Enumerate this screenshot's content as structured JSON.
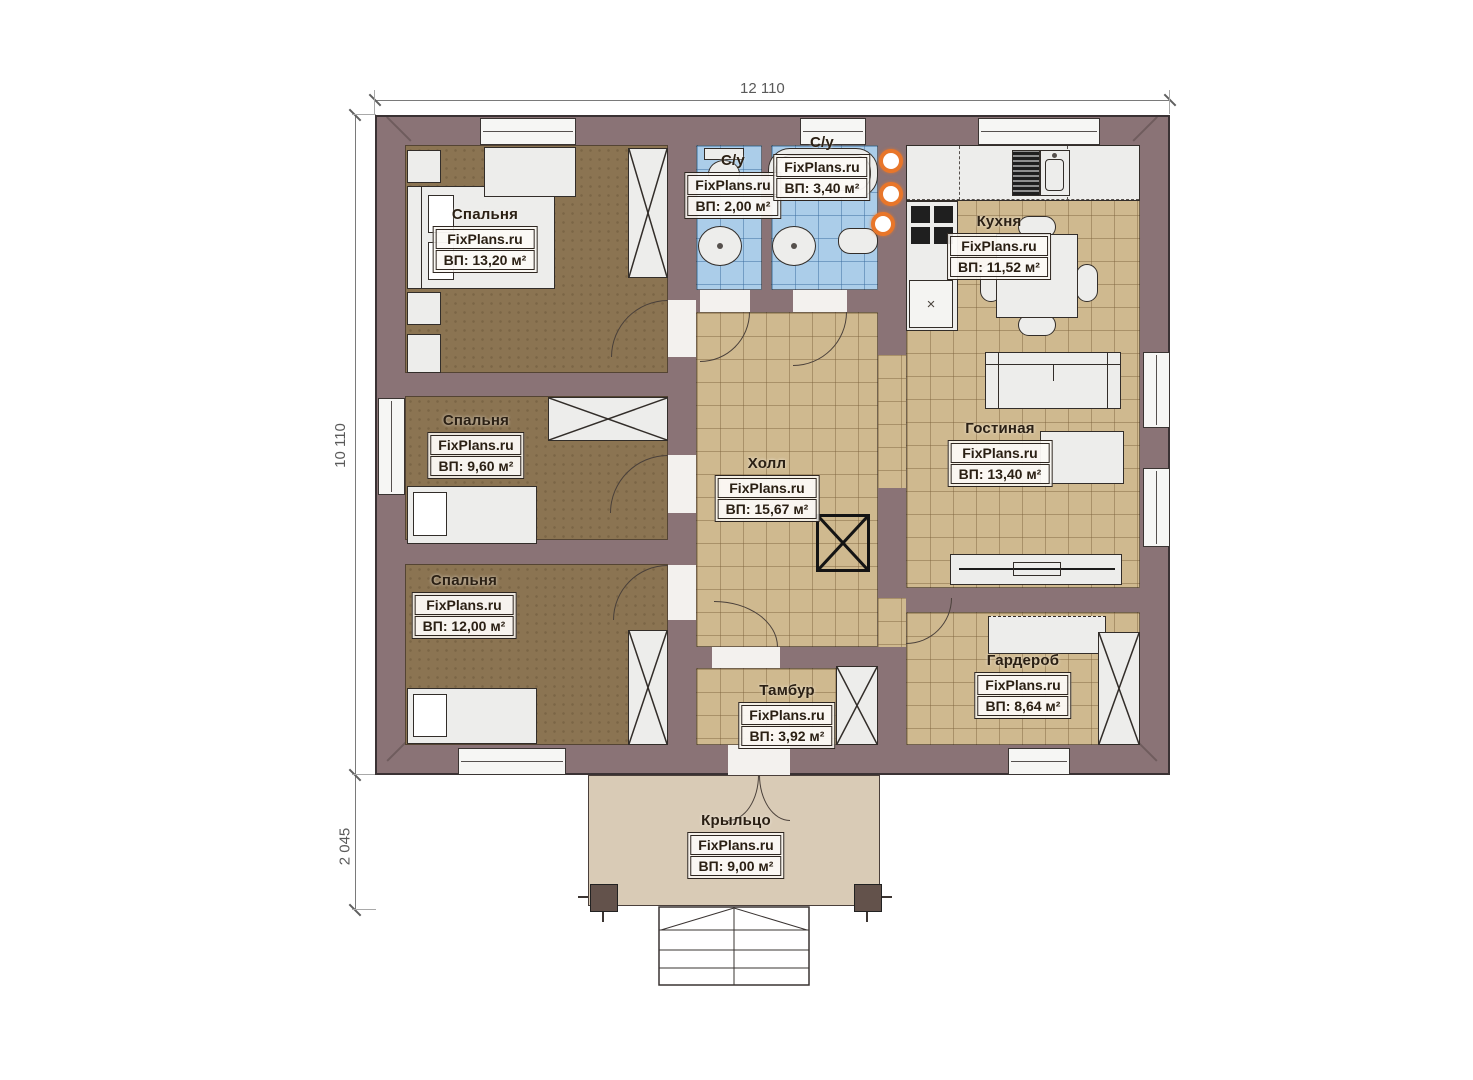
{
  "watermark": "FixPlans.ru",
  "dimensions": {
    "width_total": "12 110",
    "height_main": "10 110",
    "height_porch": "2 045"
  },
  "rooms": {
    "bedroom1": {
      "name": "Спальня",
      "area": "ВП: 13,20 м²"
    },
    "bedroom2": {
      "name": "Спальня",
      "area": "ВП: 9,60 м²"
    },
    "bedroom3": {
      "name": "Спальня",
      "area": "ВП: 12,00 м²"
    },
    "bathroom1": {
      "name": "С/у",
      "area": "ВП: 2,00 м²"
    },
    "bathroom2": {
      "name": "С/у",
      "area": "ВП: 3,40 м²"
    },
    "kitchen": {
      "name": "Кухня",
      "area": "ВП: 11,52 м²"
    },
    "living": {
      "name": "Гостиная",
      "area": "ВП: 13,40 м²"
    },
    "hall": {
      "name": "Холл",
      "area": "ВП: 15,67 м²"
    },
    "vestibule": {
      "name": "Тамбур",
      "area": "ВП: 3,92 м²"
    },
    "wardrobe": {
      "name": "Гардероб",
      "area": "ВП: 8,64 м²"
    },
    "porch": {
      "name": "Крыльцо",
      "area": "ВП: 9,00 м²"
    }
  },
  "colors": {
    "wall": "#8a7376",
    "bedroom_floor": "#8b7452",
    "tile_floor": "#cfb98f",
    "bath_tile": "#abcde9",
    "porch": "#d9cbb6",
    "equipment_orange": "#e8762a"
  }
}
